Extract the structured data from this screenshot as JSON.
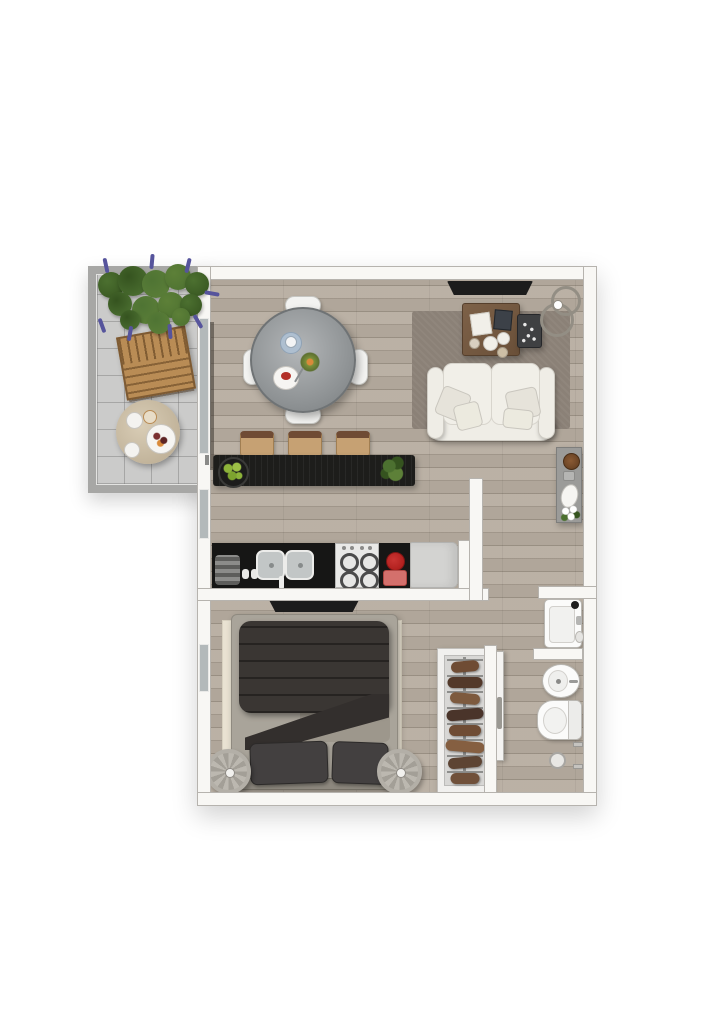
{
  "page": {
    "background": "#ffffff",
    "kind": "3d-apartment-floor-plan-top-view",
    "visible_text": ""
  },
  "palette": {
    "page_bg": "#ffffff",
    "white_wall": "#f8f7f4",
    "wall_border": "#b6b3ae",
    "wood_floor": "#b7ada0",
    "tile_floor": "#cbcbca",
    "railing": "#a7a7a5",
    "rug_living": "#8b8177",
    "rug_bedroom": "#e9e2d2",
    "sofa_white": "#efede6",
    "counter_black": "#161615",
    "bar_black": "#1d1d1b",
    "stool_tan": "#c6a173",
    "stool_back": "#6f4b34",
    "coffee_table_wood": "#74593f",
    "balcony_wood": "#b98c55",
    "duvet_dark": "#3a3633",
    "bed_base": "#a9a49a",
    "pillow_dark": "#434040",
    "fixture_white": "#fbfbfa",
    "appliance_red": "#b1201e",
    "appliance_red_light": "#d4706c",
    "plant_green": "#4c7030",
    "plant_green_dark": "#35531f",
    "lavender_purple": "#56549c",
    "console_gray": "#9b9b99",
    "glass_gray": "#b3b9ba",
    "tv_black": "#1c1c1c",
    "steel_gray": "#c2c6c6",
    "table_glass": "#8e9294"
  },
  "rooms": {
    "balcony": {
      "name": "balcony",
      "furniture": [
        "lavender-planter",
        "wooden-lounge-chair",
        "round-breakfast-table"
      ]
    },
    "living_dining": {
      "name": "living-dining-room",
      "furniture": [
        "round-glass-dining-table",
        "four-white-chairs",
        "black-breakfast-bar",
        "three-bar-stools",
        "lime-bowl",
        "bar-plant",
        "gray-rug",
        "white-sofa",
        "wood-coffee-table",
        "dark-side-table",
        "arc-floor-lamp",
        "wall-tv",
        "console-sideboard"
      ]
    },
    "kitchen": {
      "name": "kitchen",
      "furniture": [
        "black-counter",
        "double-sink",
        "gas-stove",
        "red-coffee-machine",
        "fridge"
      ]
    },
    "bedroom": {
      "name": "bedroom",
      "furniture": [
        "double-bed-dark-duvet",
        "cream-rug",
        "two-round-nightstands",
        "wall-tv",
        "open-wardrobe"
      ]
    },
    "bathroom": {
      "name": "bathroom",
      "furniture": [
        "washbasin",
        "bidet",
        "toilet",
        "paper-holder"
      ]
    }
  },
  "wardrobe": {
    "garments": [
      "#6f4c34",
      "#53392a",
      "#7d5a3e",
      "#4a342a",
      "#6f4c34",
      "#855f41",
      "#5d4433",
      "#70503a"
    ]
  },
  "balcony_foliage": {
    "blobs": [
      {
        "x": 98,
        "y": 272,
        "d": 26
      },
      {
        "x": 118,
        "y": 266,
        "d": 30
      },
      {
        "x": 142,
        "y": 270,
        "d": 28
      },
      {
        "x": 165,
        "y": 264,
        "d": 26
      },
      {
        "x": 185,
        "y": 272,
        "d": 24
      },
      {
        "x": 108,
        "y": 292,
        "d": 24
      },
      {
        "x": 132,
        "y": 296,
        "d": 28
      },
      {
        "x": 158,
        "y": 292,
        "d": 26
      },
      {
        "x": 180,
        "y": 294,
        "d": 22
      },
      {
        "x": 120,
        "y": 310,
        "d": 20
      },
      {
        "x": 148,
        "y": 312,
        "d": 22
      },
      {
        "x": 172,
        "y": 308,
        "d": 18
      }
    ],
    "spikes": [
      {
        "x": 104,
        "y": 258,
        "r": -12
      },
      {
        "x": 150,
        "y": 254,
        "r": 5
      },
      {
        "x": 186,
        "y": 258,
        "r": 14
      },
      {
        "x": 100,
        "y": 318,
        "r": 160
      },
      {
        "x": 128,
        "y": 326,
        "r": 190
      },
      {
        "x": 168,
        "y": 324,
        "r": 175
      },
      {
        "x": 196,
        "y": 314,
        "r": 150
      },
      {
        "x": 210,
        "y": 286,
        "r": 100
      }
    ]
  }
}
